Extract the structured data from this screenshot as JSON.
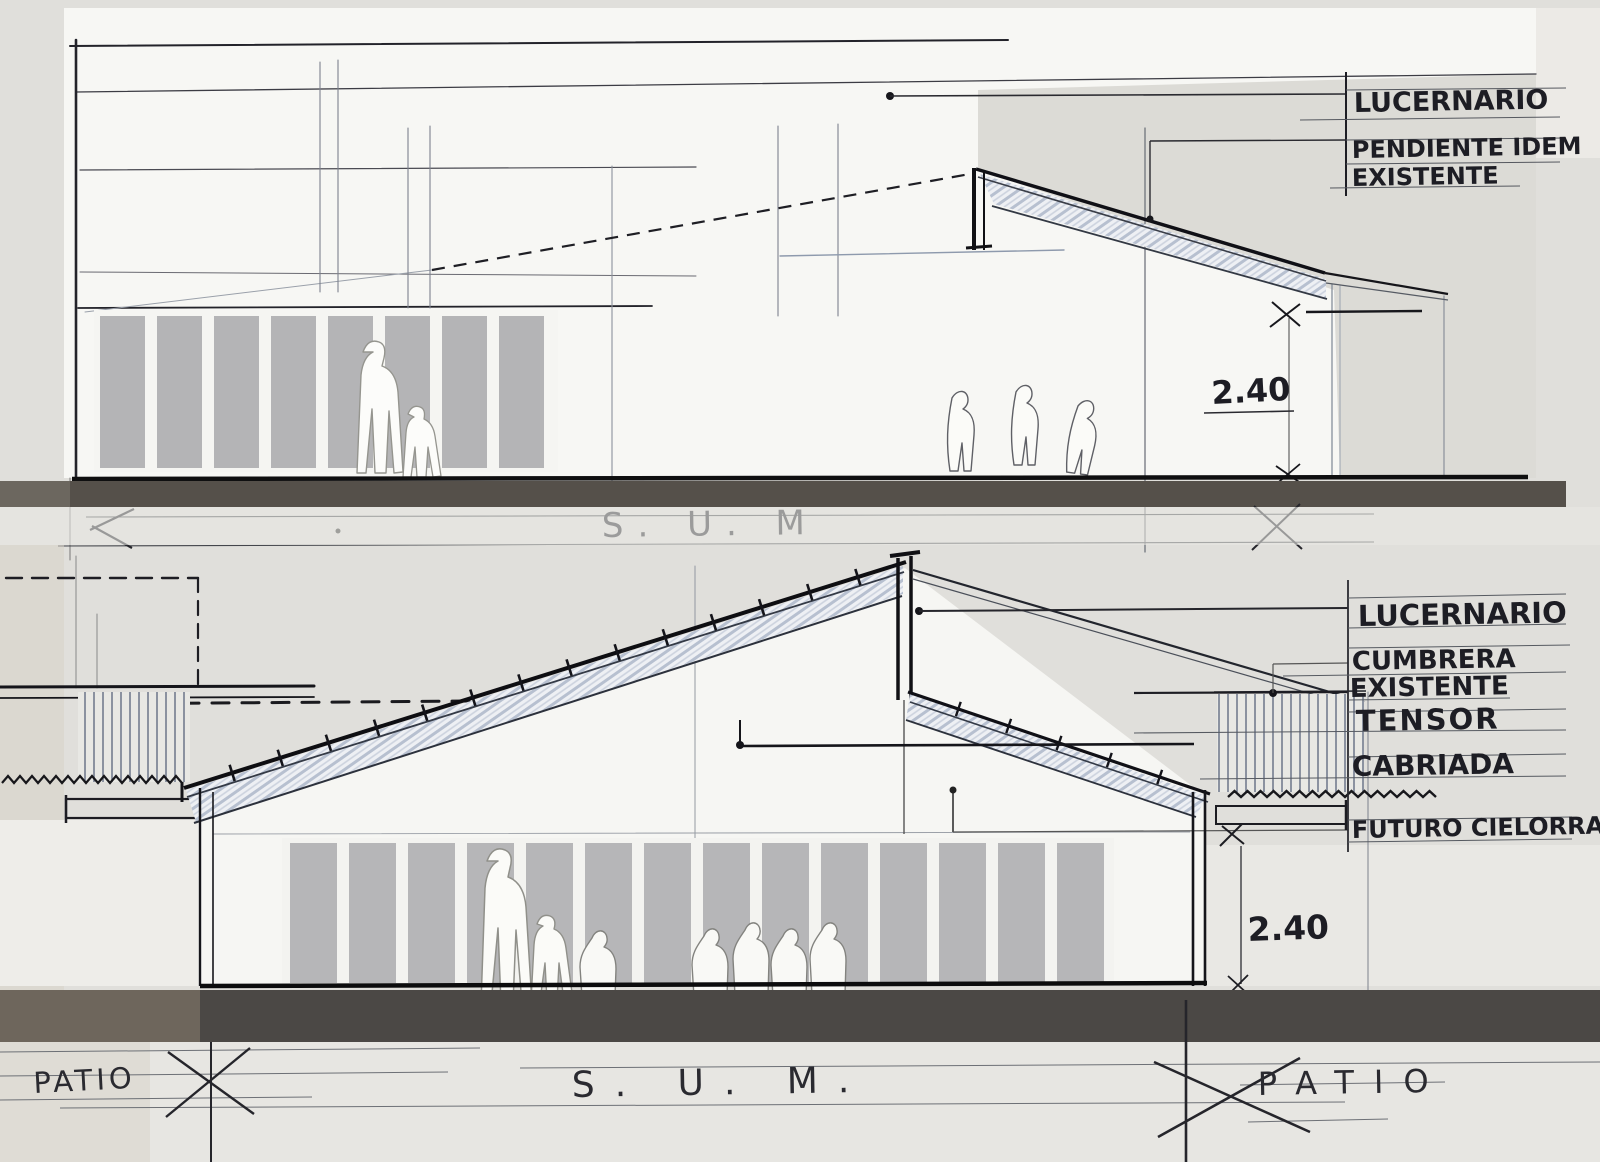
{
  "colors": {
    "paper": "#f6f6f3",
    "background": "#e0dfdb",
    "ink": "#17171c",
    "pencil_blue": "#8e9aad",
    "ground_dark": "#4b4845",
    "ground_brown": "#6e665c",
    "panel_gray": "#b6b6b8",
    "roof_hatch": "#9aa7bd"
  },
  "top_section": {
    "callout_lucernario": "LUCERNARIO",
    "callout_pendiente_line1": "PENDIENTE IDEM",
    "callout_pendiente_line2": "EXISTENTE",
    "height_dimension": "2.40",
    "room_label": "S. U. M"
  },
  "bottom_section": {
    "callout_lucernario": "LUCERNARIO",
    "callout_cumbrera_line1": "CUMBRERA",
    "callout_cumbrera_line2": "EXISTENTE",
    "callout_tensor": "TENSOR",
    "callout_cabriada": "CABRIADA",
    "callout_futuro_cielorraso": "FUTURO CIELORRASO",
    "height_dimension": "2.40",
    "room_label_left": "PATIO",
    "room_label_center": "S. U. M.",
    "room_label_right": "PATIO"
  }
}
